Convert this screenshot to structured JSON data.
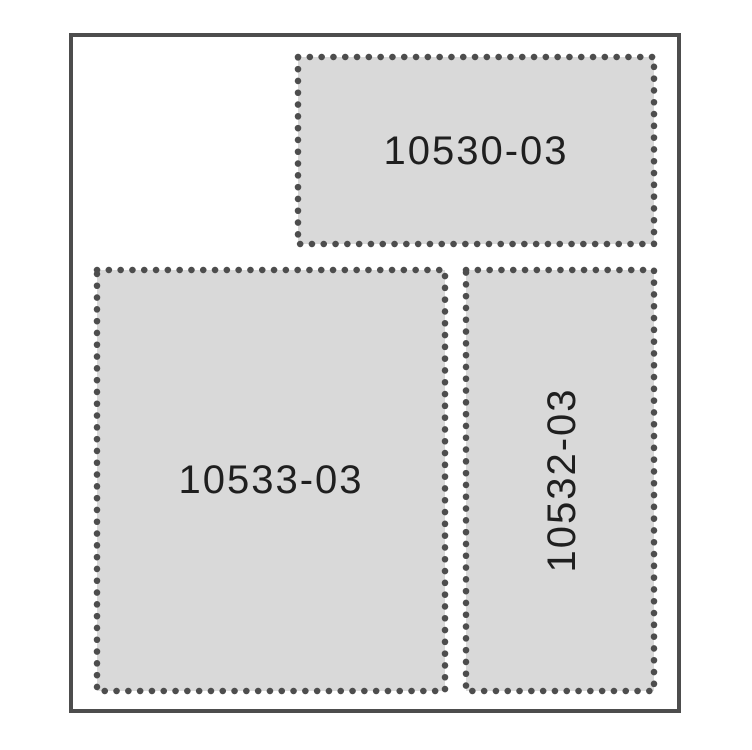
{
  "diagram": {
    "colors": {
      "background": "#ffffff",
      "frame_stroke": "#4d4d4d",
      "panel_fill": "#d9d9d9",
      "dot_color": "#4d4d4d",
      "label_color": "#1f1f1f"
    },
    "panels": [
      {
        "id": "top",
        "label": "10530-03",
        "orientation": "horizontal"
      },
      {
        "id": "bottom-left",
        "label": "10533-03",
        "orientation": "horizontal"
      },
      {
        "id": "bottom-right",
        "label": "10532-03",
        "orientation": "vertical"
      }
    ]
  }
}
